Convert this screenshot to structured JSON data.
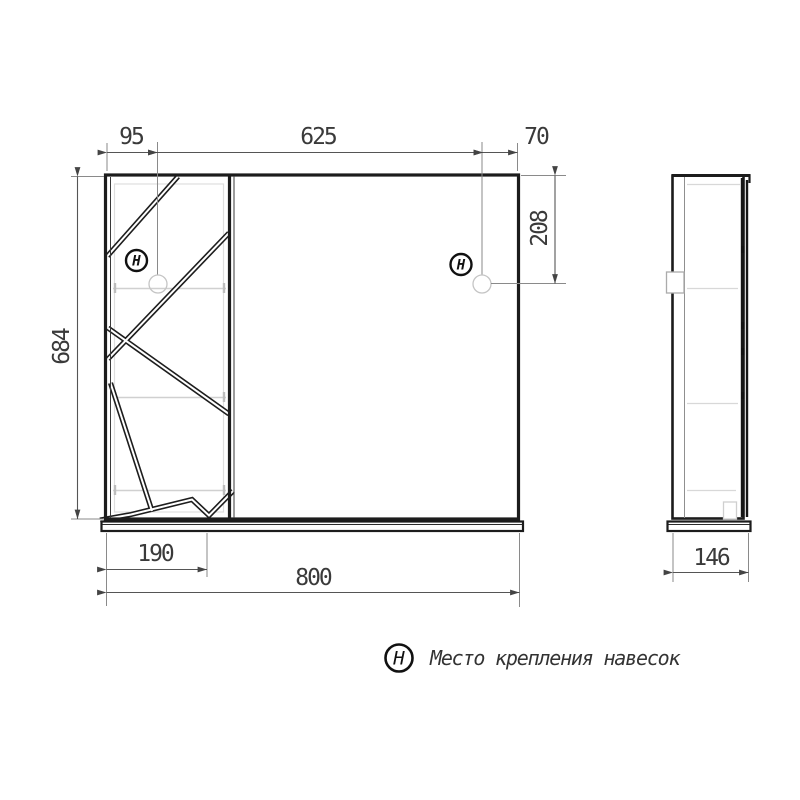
{
  "drawing": {
    "dimensions": {
      "left_door_width": "95",
      "mirror_width": "625",
      "right_offset": "70",
      "total_height": "684",
      "hanger_drop": "208",
      "left_section_width": "190",
      "total_width": "800",
      "side_depth": "146"
    },
    "markers": {
      "hanger_symbol_left": "H",
      "hanger_symbol_right": "H"
    },
    "legend": {
      "symbol": "H",
      "label": "Место крепления навесок"
    },
    "colors": {
      "outline": "#1c1c1c",
      "dim_line": "#555555",
      "light_detail": "#cccccc"
    }
  }
}
